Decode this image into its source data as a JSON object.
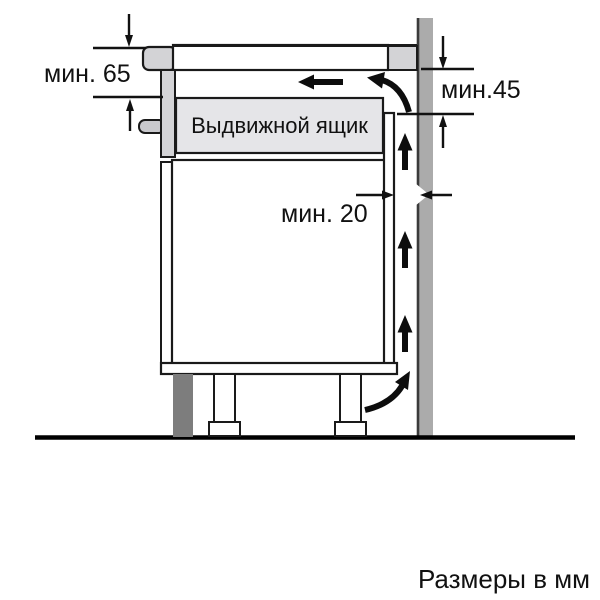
{
  "diagram": {
    "title_hint": "hob-installation-clearance-diagram",
    "labels": {
      "min65": "мин. 65",
      "min45": "мин.45",
      "min20": "мин. 20",
      "drawer": "Выдвижной ящик",
      "units": "Размеры в мм"
    },
    "colors": {
      "background": "#ffffff",
      "outline": "#1a1a1a",
      "arrow_black": "#0d0d0d",
      "hob_gray": "#d3d3d6",
      "handle_gray": "#c9c9cd",
      "drawer_fill": "#e5e5e8",
      "wall_gray": "#ababab",
      "wall_edge": "#3a3a3a",
      "plinth_gray": "#7d7d7d"
    }
  }
}
